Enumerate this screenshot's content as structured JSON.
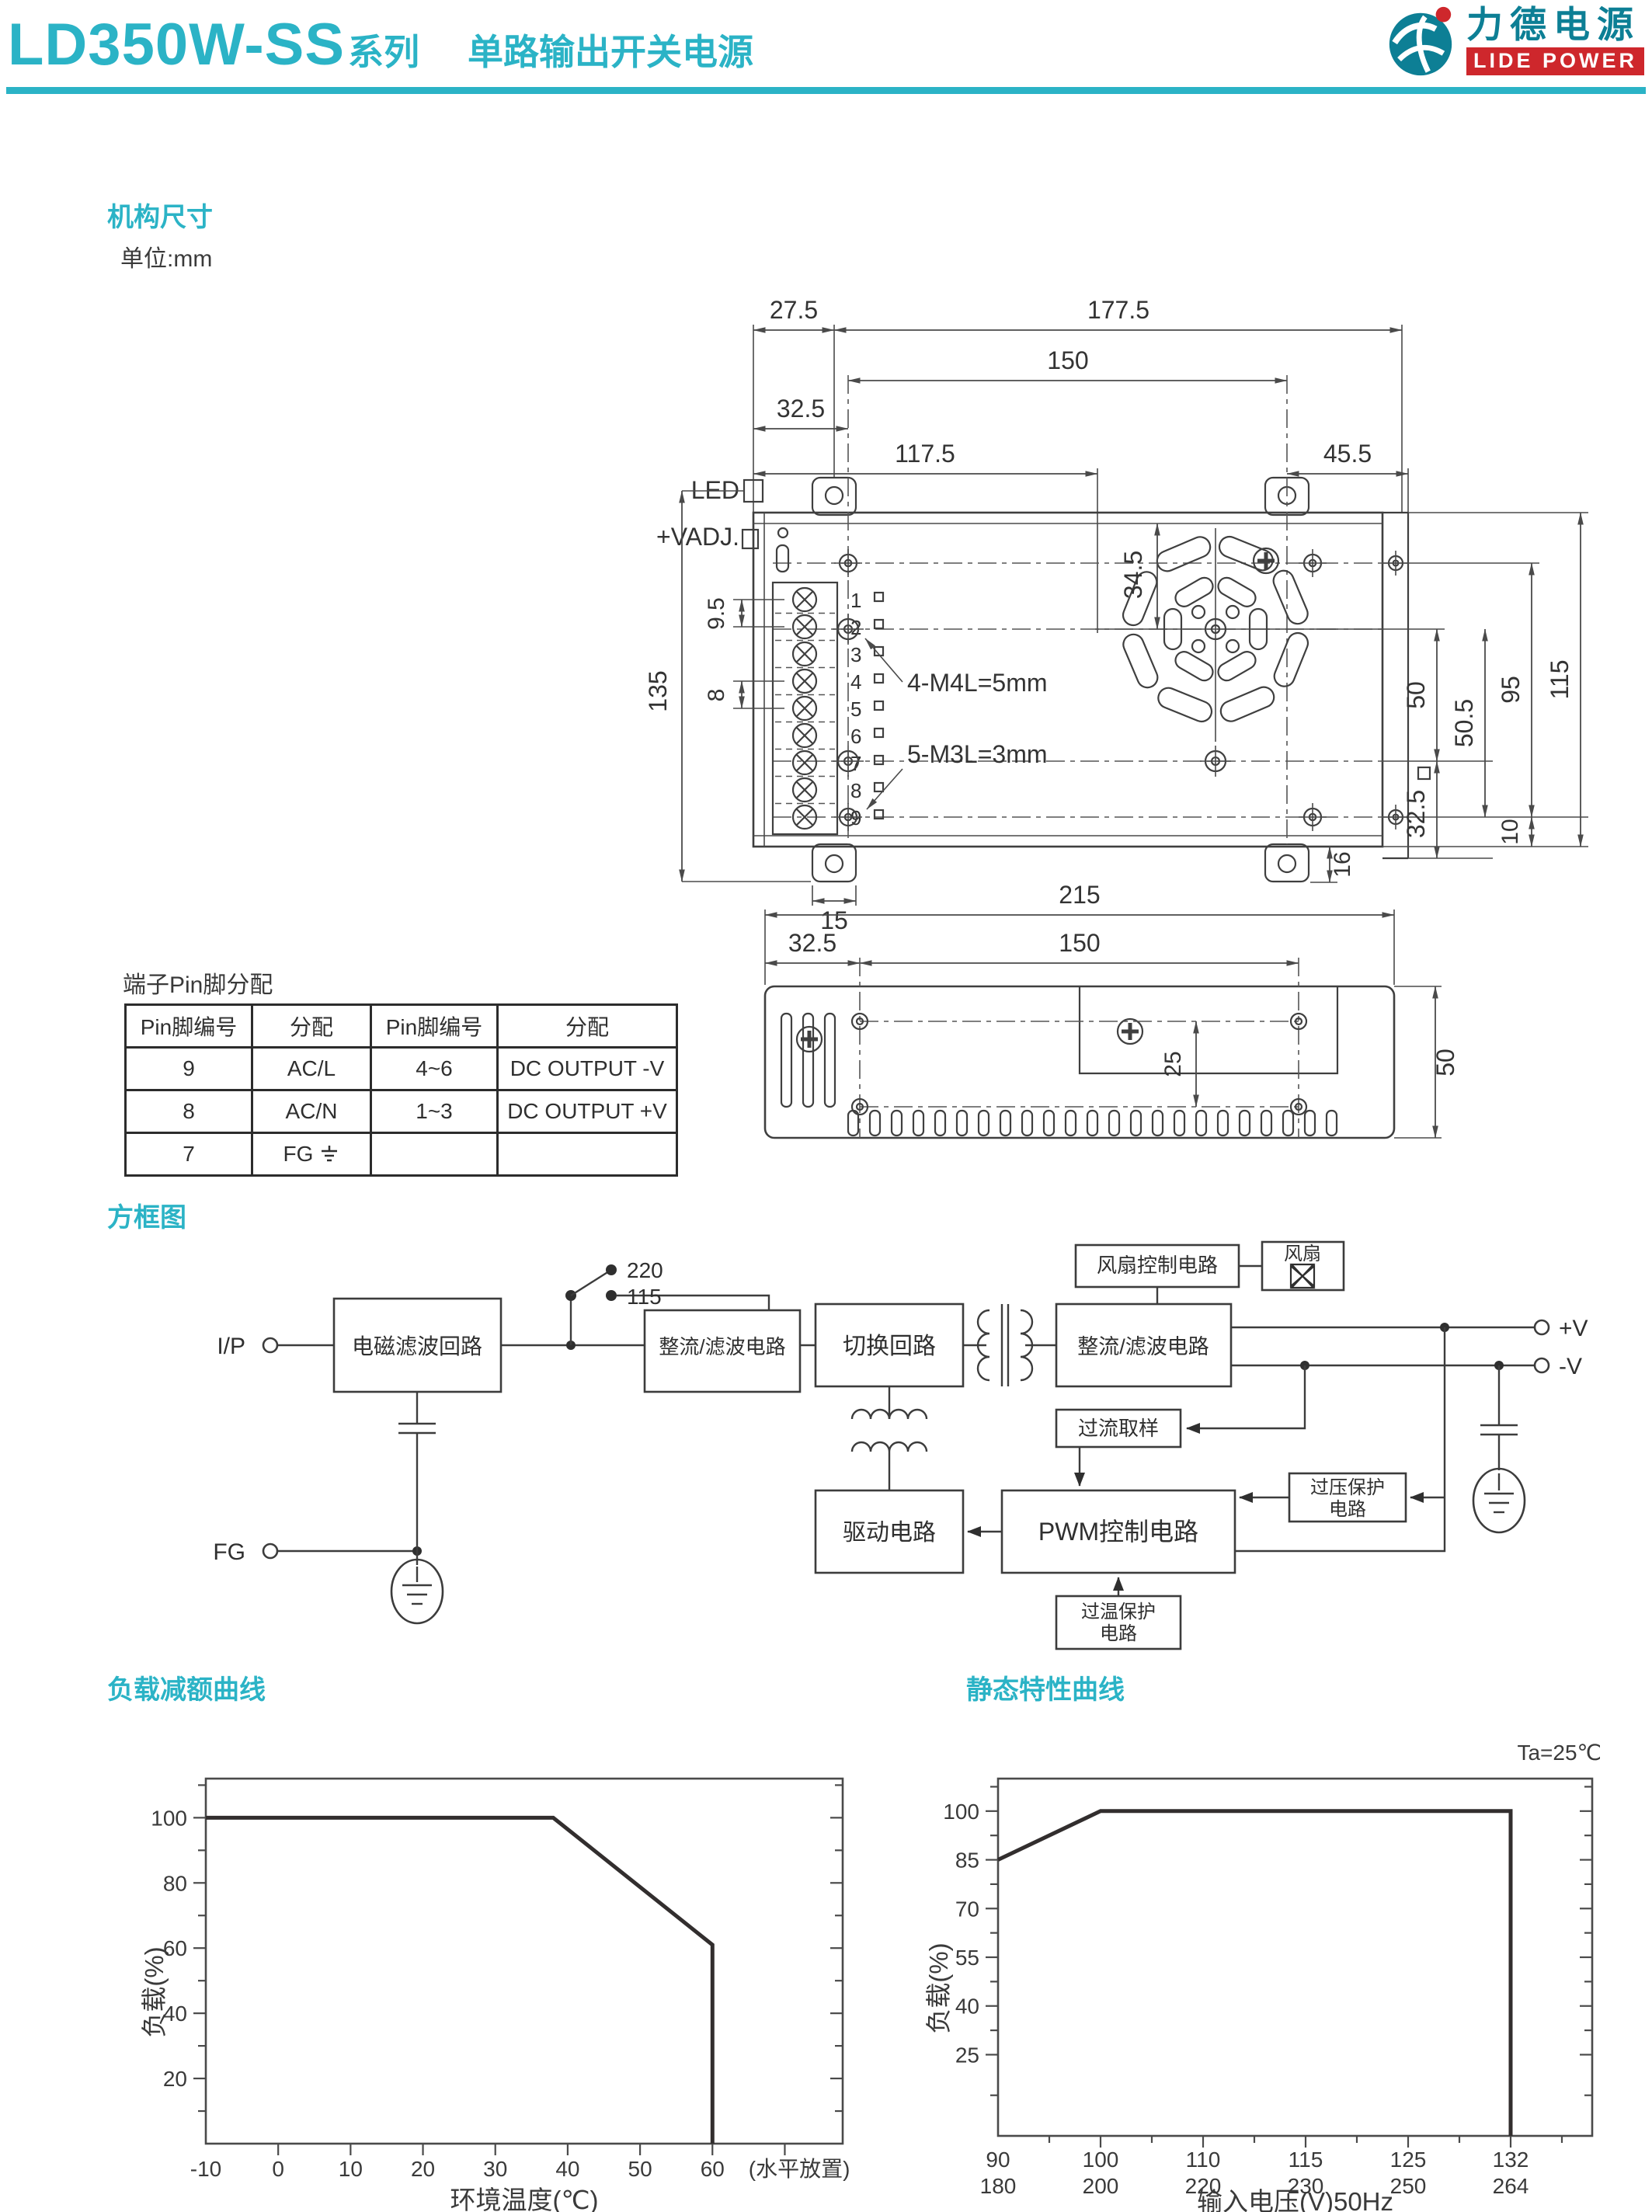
{
  "header": {
    "series": "LD350W-SS",
    "series_label": "系列",
    "subtitle": "单路输出开关电源",
    "logo_cn": "力德电源",
    "logo_en": "LIDE POWER"
  },
  "colors": {
    "accent": "#2bb3c6",
    "logo_teal": "#0d7f95",
    "logo_red": "#ce272c",
    "ink": "#3a3a3a"
  },
  "mech": {
    "title": "机构尺寸",
    "unit": "单位:mm",
    "labels": {
      "led": "LED",
      "vadj": "+VADJ.",
      "m4": "4-M4L=5mm",
      "m3": "5-M3L=3mm"
    },
    "terminals": [
      "1",
      "2",
      "3",
      "4",
      "5",
      "6",
      "7",
      "8",
      "9"
    ],
    "top_dims": {
      "tab_offset": "27.5",
      "body": "177.5",
      "holes": "150",
      "left_col": "32.5",
      "mid": "117.5",
      "right_col": "45.5"
    },
    "left_dims": {
      "total": "135",
      "pitch_a": "9.5",
      "pitch_b": "8"
    },
    "right_dims": {
      "fan": "34.5",
      "fan_mid": "50",
      "holes": "95",
      "total": "115",
      "sq": "32.5",
      "mid_bot": "50.5",
      "bottom": "10",
      "tab": "16"
    },
    "bottom_dims": {
      "tab": "15"
    },
    "side_view": {
      "total": "215",
      "left": "32.5",
      "holes": "150",
      "pitch": "25",
      "height": "50"
    }
  },
  "pin_table": {
    "title": "端子Pin脚分配",
    "headers": [
      "Pin脚编号",
      "分配",
      "Pin脚编号",
      "分配"
    ],
    "rows": [
      [
        "9",
        "AC/L",
        "4~6",
        "DC OUTPUT -V"
      ],
      [
        "8",
        "AC/N",
        "1~3",
        "DC OUTPUT +V"
      ],
      [
        "7",
        "FG",
        "",
        ""
      ]
    ]
  },
  "block": {
    "title": "方框图",
    "io": {
      "ip": "I/P",
      "fg": "FG",
      "vplus": "+V",
      "vminus": "-V"
    },
    "switch": {
      "top": "220",
      "bottom": "115"
    },
    "boxes": {
      "emi": "电磁滤波回路",
      "rect1": "整流/滤波电路",
      "sw": "切换回路",
      "rect2": "整流/滤波电路",
      "fan_ctrl": "风扇控制电路",
      "fan": "风扇",
      "oc": "过流取样",
      "pwm": "PWM控制电路",
      "ovp1": "过压保护",
      "ovp2": "电路",
      "drv": "驱动电路",
      "otp1": "过温保护",
      "otp2": "电路"
    }
  },
  "chart_data": [
    {
      "type": "line",
      "title": "负载减额曲线",
      "xlabel": "环境温度(℃)",
      "ylabel": "负载(%)",
      "note": "(水平放置)",
      "note_x": 72,
      "x_mode": "linear",
      "xlim": [
        -10,
        78
      ],
      "ylim": [
        0,
        112
      ],
      "x_ticks": [
        {
          "v": -10,
          "l": "-10"
        },
        {
          "v": 0,
          "l": "0"
        },
        {
          "v": 10,
          "l": "10"
        },
        {
          "v": 20,
          "l": "20"
        },
        {
          "v": 30,
          "l": "30"
        },
        {
          "v": 40,
          "l": "40"
        },
        {
          "v": 50,
          "l": "50"
        },
        {
          "v": 60,
          "l": "60"
        },
        {
          "v": 70,
          "l": ""
        }
      ],
      "y_major": [
        {
          "v": 20,
          "l": "20"
        },
        {
          "v": 40,
          "l": "40"
        },
        {
          "v": 60,
          "l": "60"
        },
        {
          "v": 80,
          "l": "80"
        },
        {
          "v": 100,
          "l": "100"
        }
      ],
      "y_minor": [
        10,
        30,
        50,
        70,
        90,
        110
      ],
      "points": [
        [
          -10,
          100
        ],
        [
          38,
          100
        ],
        [
          60,
          61
        ],
        [
          60,
          0
        ]
      ]
    },
    {
      "type": "line",
      "title": "静态特性曲线",
      "annotation": "Ta=25℃",
      "xlabel": "输入电压(V)50Hz",
      "ylabel": "负载(%)",
      "x_mode": "ordinal",
      "ylim": [
        0,
        110
      ],
      "x_ticks": [
        {
          "v": 90,
          "l": "90",
          "l2": "180"
        },
        {
          "v": 100,
          "l": "100",
          "l2": "200"
        },
        {
          "v": 110,
          "l": "110",
          "l2": "220"
        },
        {
          "v": 115,
          "l": "115",
          "l2": "230"
        },
        {
          "v": 125,
          "l": "125",
          "l2": "250"
        },
        {
          "v": 132,
          "l": "132",
          "l2": "264"
        }
      ],
      "y_major": [
        {
          "v": 25,
          "l": "25"
        },
        {
          "v": 40,
          "l": "40"
        },
        {
          "v": 55,
          "l": "55"
        },
        {
          "v": 70,
          "l": "70"
        },
        {
          "v": 85,
          "l": "85"
        },
        {
          "v": 100,
          "l": "100"
        }
      ],
      "y_minor": [
        12.5,
        32.5,
        47.5,
        62.5,
        77.5,
        92.5,
        107.5
      ],
      "points": [
        [
          90,
          85
        ],
        [
          100,
          100
        ],
        [
          132,
          100
        ],
        [
          132,
          0
        ]
      ]
    }
  ]
}
